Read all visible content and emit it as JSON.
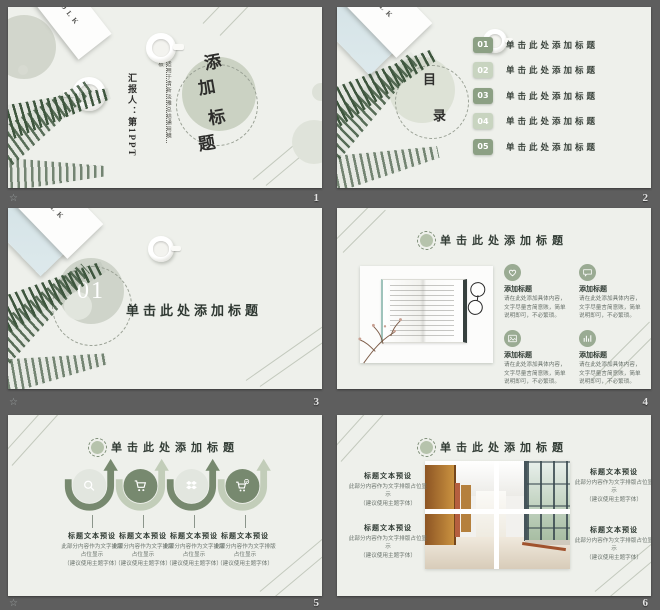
{
  "colors": {
    "accent_dark": "#8ca084",
    "accent_light": "#c8d4c0",
    "slide_bg": "#eef0eb",
    "board_bg": "#5e5e5e",
    "title_text": "#323c35"
  },
  "footer": {
    "watermark": "☆",
    "numbers": [
      "1",
      "2",
      "3",
      "4",
      "5",
      "6"
    ]
  },
  "decor": {
    "folk_label": "FOLK"
  },
  "slides": {
    "s1": {
      "title_chars": [
        "添",
        "加",
        "标",
        "题"
      ],
      "tagline": "适用于清新淡雅总结通用模板",
      "presenter": "汇报人：第1PPT"
    },
    "s2": {
      "toc_chars": [
        "目",
        "录"
      ],
      "items": [
        {
          "num": "01",
          "label": "单击此处添加标题"
        },
        {
          "num": "02",
          "label": "单击此处添加标题"
        },
        {
          "num": "03",
          "label": "单击此处添加标题"
        },
        {
          "num": "04",
          "label": "单击此处添加标题"
        },
        {
          "num": "05",
          "label": "单击此处添加标题"
        }
      ]
    },
    "s3": {
      "num": "01",
      "title": "单击此处添加标题"
    },
    "s4": {
      "title": "单击此处添加标题",
      "items": [
        {
          "icon": "heart",
          "heading": "添加标题",
          "body": "请在此处添加具体内容，文字尽量言简意赅，简单说明即可，不必繁琐。"
        },
        {
          "icon": "chat",
          "heading": "添加标题",
          "body": "请在此处添加具体内容，文字尽量言简意赅，简单说明即可，不必繁琐。"
        },
        {
          "icon": "photo",
          "heading": "添加标题",
          "body": "请在此处添加具体内容，文字尽量言简意赅，简单说明即可，不必繁琐。"
        },
        {
          "icon": "chart",
          "heading": "添加标题",
          "body": "请在此处添加具体内容，文字尽量言简意赅，简单说明即可，不必繁琐。"
        }
      ]
    },
    "s5": {
      "title": "单击此处添加标题",
      "items": [
        {
          "icon": "search",
          "heading": "标题文本预设",
          "body": "此部分内容作为文字排版占位显示",
          "note": "（建议使用主题字体）"
        },
        {
          "icon": "cart",
          "heading": "标题文本预设",
          "body": "此部分内容作为文字排版占位显示",
          "note": "（建议使用主题字体）"
        },
        {
          "icon": "share",
          "heading": "标题文本预设",
          "body": "此部分内容作为文字排版占位显示",
          "note": "（建议使用主题字体）"
        },
        {
          "icon": "cart-check",
          "heading": "标题文本预设",
          "body": "此部分内容作为文字排版占位显示",
          "note": "（建议使用主题字体）"
        }
      ]
    },
    "s6": {
      "title": "单击此处添加标题",
      "items": [
        {
          "heading": "标题文本预设",
          "body": "此部分内容作为文字排版占位显示",
          "note": "（建议使用主题字体）"
        },
        {
          "heading": "标题文本预设",
          "body": "此部分内容作为文字排版占位显示",
          "note": "（建议使用主题字体）"
        },
        {
          "heading": "标题文本预设",
          "body": "此部分内容作为文字排版占位显示",
          "note": "（建议使用主题字体）"
        },
        {
          "heading": "标题文本预设",
          "body": "此部分内容作为文字排版占位显示",
          "note": "（建议使用主题字体）"
        }
      ]
    }
  }
}
